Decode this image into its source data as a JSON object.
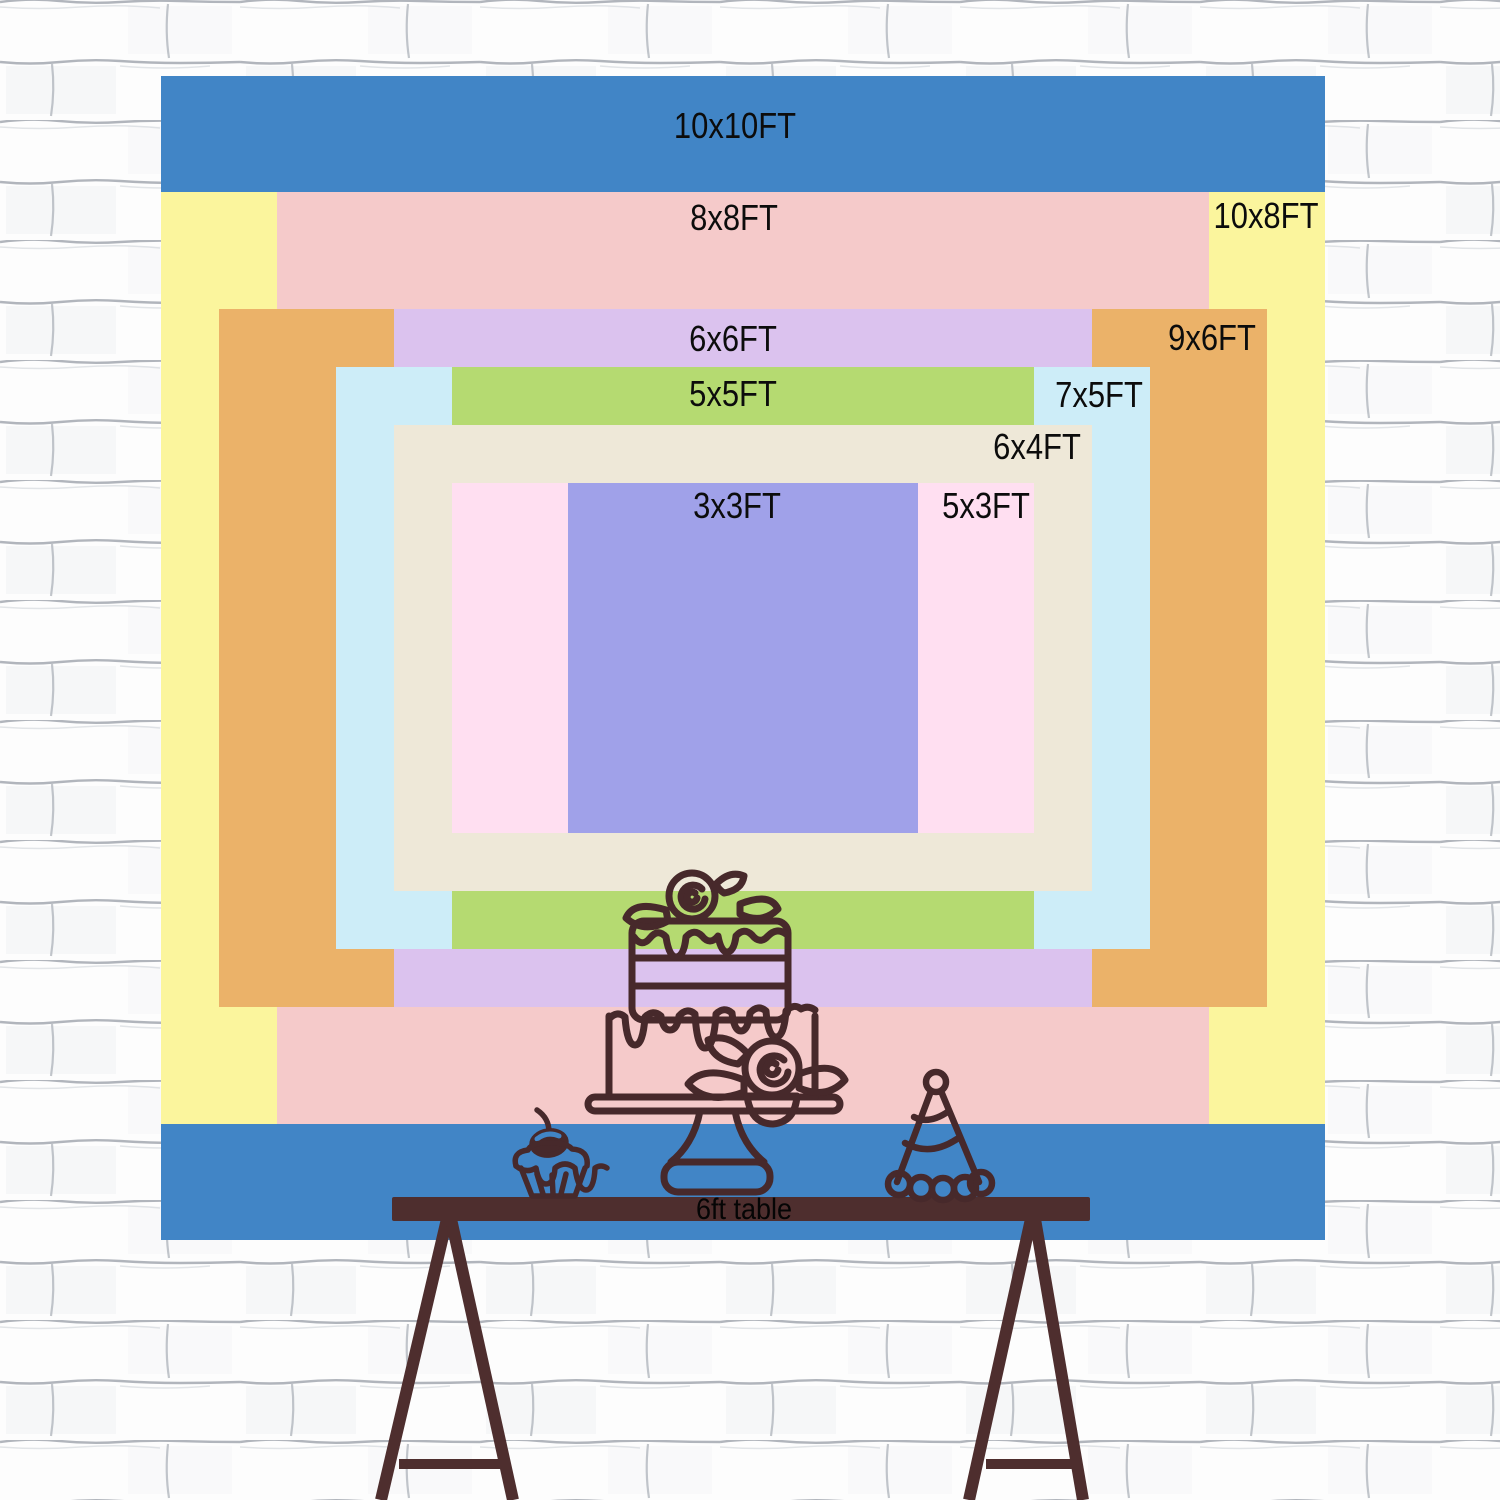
{
  "backdrop": {
    "center_x": 743,
    "center_y": 658,
    "px_per_ft": 116.4,
    "sizes": [
      {
        "label": "10x10FT",
        "width_ft": 10,
        "height_ft": 10,
        "color": "#4185c6",
        "label_x": 735,
        "label_y": 126
      },
      {
        "label": "10x8FT",
        "width_ft": 10,
        "height_ft": 8,
        "color": "#fbf59d",
        "label_x": 1266,
        "label_y": 216
      },
      {
        "label": "8x8FT",
        "width_ft": 8,
        "height_ft": 8,
        "color": "#f5caca",
        "label_x": 734,
        "label_y": 218
      },
      {
        "label": "9x6FT",
        "width_ft": 9,
        "height_ft": 6,
        "color": "#ebb269",
        "label_x": 1212,
        "label_y": 338
      },
      {
        "label": "6x6FT",
        "width_ft": 6,
        "height_ft": 6,
        "color": "#dbc2ee",
        "label_x": 733,
        "label_y": 339
      },
      {
        "label": "7x5FT",
        "width_ft": 7,
        "height_ft": 5,
        "color": "#cdedf8",
        "label_x": 1099,
        "label_y": 395
      },
      {
        "label": "5x5FT",
        "width_ft": 5,
        "height_ft": 5,
        "color": "#b5da71",
        "label_x": 733,
        "label_y": 394
      },
      {
        "label": "6x4FT",
        "width_ft": 6,
        "height_ft": 4,
        "color": "#eee8d8",
        "label_x": 1037,
        "label_y": 447
      },
      {
        "label": "5x3FT",
        "width_ft": 5,
        "height_ft": 3,
        "color": "#ffdff1",
        "label_x": 986,
        "label_y": 506
      },
      {
        "label": "3x3FT",
        "width_ft": 3,
        "height_ft": 3,
        "color": "#a0a1e9",
        "label_x": 737,
        "label_y": 506
      }
    ]
  },
  "table": {
    "label": "6ft table",
    "label_x": 744,
    "label_y": 1210,
    "color": "#4e2e2e"
  },
  "illustration": {
    "outline_color": "#47292b",
    "items": [
      "cupcake",
      "tiered-cake",
      "party-hat"
    ]
  },
  "wall": {
    "base_color": "#fdfdfd",
    "mortar_line_color": "#9298a1"
  }
}
